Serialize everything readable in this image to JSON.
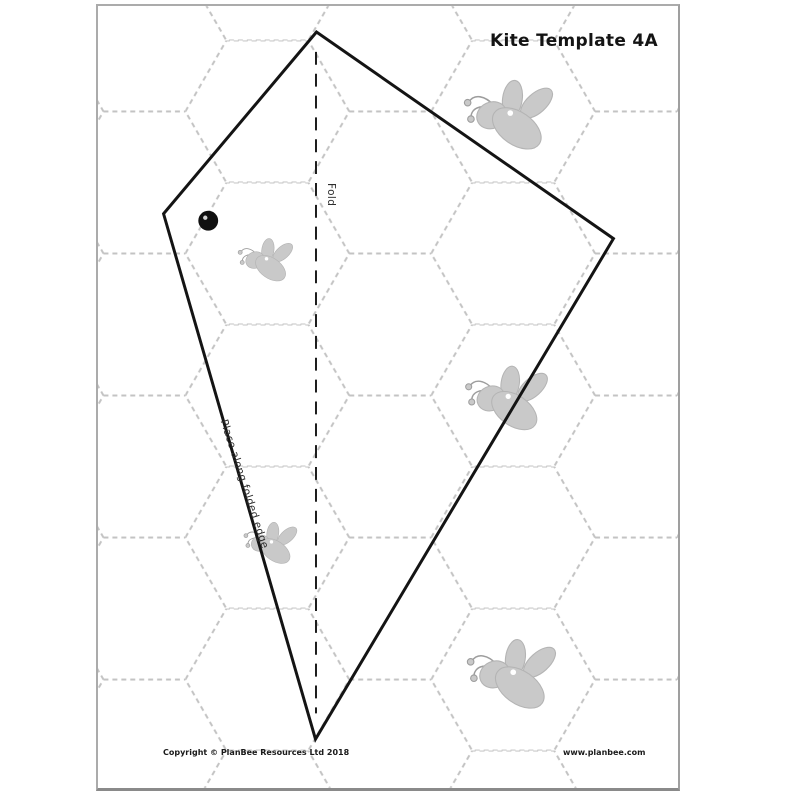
{
  "page": {
    "title": "Kite Template 4A",
    "fold_label": "Fold",
    "edge_label": "Place along folded edge",
    "footer": {
      "copyright": "Copyright © PlanBee Resources Ltd 2018",
      "website": "www.planbee.com"
    }
  },
  "colors": {
    "canvas_bg": "#ffffff",
    "page_bg": "#ffffff",
    "page_border": "#ababab",
    "hexagon_line": "#c3c3c3",
    "kite_outline": "#141414",
    "fold_line": "#1d1d1d",
    "punch_dot": "#101010",
    "bee_fill": "#c9c9c9",
    "bee_outline": "#b4b4b4",
    "antenna_line": "#9d9d9d",
    "eye_fill": "#ffffff",
    "text": "#1a1a1a"
  },
  "diagram": {
    "kite_points": "220,26 66,209 219,738 519,234",
    "fold_path": "M 219.5 46 L 219.5 712",
    "fold_dash": "13 9",
    "hexagon_dash": "5 4",
    "punch_dot": {
      "x": 111,
      "y": 216,
      "r": 10
    },
    "bees": [
      {
        "name": "bee-top-right",
        "x": 414,
        "y": 112,
        "scale": 1.1
      },
      {
        "name": "bee-mid-left",
        "x": 169,
        "y": 257,
        "scale": 0.68
      },
      {
        "name": "bee-mid-right",
        "x": 412,
        "y": 397,
        "scale": 1.02
      },
      {
        "name": "bee-lower-left",
        "x": 174,
        "y": 542,
        "scale": 0.66
      },
      {
        "name": "bee-bottom-right",
        "x": 417,
        "y": 675,
        "scale": 1.1
      }
    ]
  }
}
